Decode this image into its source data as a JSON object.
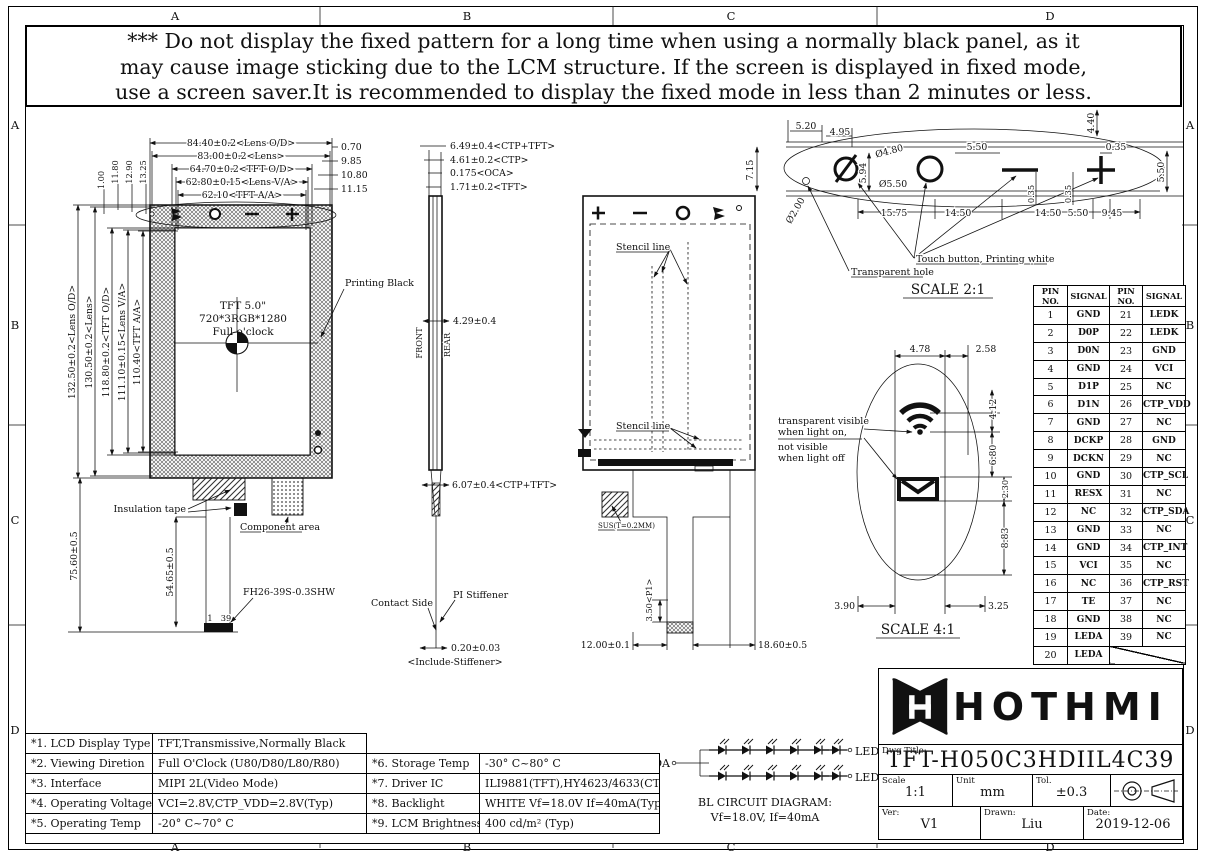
{
  "sheet": {
    "zones_top": [
      "A",
      "B",
      "C",
      "D"
    ],
    "zones_bottom": [
      "A",
      "B",
      "C",
      "D"
    ],
    "zones_left": [
      "A",
      "B",
      "C",
      "D"
    ],
    "zones_right": [
      "A",
      "B",
      "C",
      "D"
    ]
  },
  "warning": {
    "line1": "*** Do not display the fixed pattern for a long time when using a normally black panel, as it",
    "line2": "may cause image sticking due to the LCM structure. If the screen is displayed in fixed mode,",
    "line3": "use a screen saver.It is recommended to display the fixed mode in less than 2 minutes or less."
  },
  "front_view": {
    "dims_top": [
      "84.40±0.2<Lens O/D>",
      "83.00±0.2<Lens>",
      "64.70±0.2<TFT O/D>",
      "62.80±0.15<Lens V/A>",
      "62.10<TFT A/A>"
    ],
    "dims_top_right": [
      "0.70",
      "9.85",
      "10.80",
      "11.15"
    ],
    "dims_left": [
      "132.50±0.2<Lens O/D>",
      "130.50±0.2<Lens>",
      "118.80±0.2<TFT O/D>",
      "111.10±0.15<Lens V/A>",
      "110.40<TFT A/A>"
    ],
    "dims_left_top": [
      "1.00",
      "11.80",
      "12.90",
      "13.25"
    ],
    "dim_total_height": "75.60±0.5",
    "dim_fpc_height": "54.65±0.5",
    "panel_line1": "TFT 5.0\"",
    "panel_line2": "720*3RGB*1280",
    "panel_line3": "Full o'clock",
    "printing_black": "Printing Black",
    "insulation_tape": "Insulation tape",
    "component_area": "Component area",
    "connector": "FH26-39S-0.3SHW",
    "pin_first": "1",
    "pin_last": "39"
  },
  "side_view": {
    "dims_top": [
      "6.49±0.4<CTP+TFT>",
      "4.61±0.2<CTP>",
      "0.175<OCA>",
      "1.71±0.2<TFT>"
    ],
    "dim_mid": "4.29±0.4",
    "dim_lower": "6.07±0.4<CTP+TFT>",
    "front": "FRONT",
    "rear": "REAR",
    "contact_side": "Contact Side",
    "pi_stiffener": "PI Stiffener",
    "dim_tail": "0.20±0.03",
    "tail_note": "<Include-Stiffener>"
  },
  "rear_view": {
    "stencil_top": "Stencil line",
    "stencil_bottom": "Stencil line",
    "sus": "SUS(T=0.2MM)",
    "dim_pitch": "3.50<P1>",
    "dim_fpc_left": "12.00±0.1",
    "dim_fpc_right": "18.60±0.5"
  },
  "detail21": {
    "scale": "SCALE 2:1",
    "touch_label": "Touch button, Printing white",
    "hole_label": "Transparent hole",
    "dims": [
      "5.20",
      "4.95",
      "7.15",
      "Ø2.00",
      "Ø4.80",
      "Ø5.50",
      "5.94",
      "5.50",
      "0.35",
      "4.40",
      "5.50",
      "0.35",
      "0.35",
      "15.75",
      "14.50",
      "14.50",
      "5.50",
      "9.45"
    ]
  },
  "detail41": {
    "scale": "SCALE 4:1",
    "note1": "transparent visible",
    "note2": "when light on,",
    "note3": "not visible",
    "note4": "when light off",
    "dims": [
      "4.78",
      "2.58",
      "4.12",
      "6.80",
      "2.30",
      "8.83",
      "3.90",
      "3.25"
    ]
  },
  "pin_table": {
    "headers": [
      "PIN NO.",
      "SIGNAL",
      "PIN NO.",
      "SIGNAL"
    ],
    "rows": [
      [
        "1",
        "GND",
        "21",
        "LEDK"
      ],
      [
        "2",
        "D0P",
        "22",
        "LEDK"
      ],
      [
        "3",
        "D0N",
        "23",
        "GND"
      ],
      [
        "4",
        "GND",
        "24",
        "VCI"
      ],
      [
        "5",
        "D1P",
        "25",
        "NC"
      ],
      [
        "6",
        "D1N",
        "26",
        "CTP_VDD"
      ],
      [
        "7",
        "GND",
        "27",
        "NC"
      ],
      [
        "8",
        "DCKP",
        "28",
        "GND"
      ],
      [
        "9",
        "DCKN",
        "29",
        "NC"
      ],
      [
        "10",
        "GND",
        "30",
        "CTP_SCL"
      ],
      [
        "11",
        "RESX",
        "31",
        "NC"
      ],
      [
        "12",
        "NC",
        "32",
        "CTP_SDA"
      ],
      [
        "13",
        "GND",
        "33",
        "NC"
      ],
      [
        "14",
        "GND",
        "34",
        "CTP_INT"
      ],
      [
        "15",
        "VCI",
        "35",
        "NC"
      ],
      [
        "16",
        "NC",
        "36",
        "CTP_RST"
      ],
      [
        "17",
        "TE",
        "37",
        "NC"
      ],
      [
        "18",
        "GND",
        "38",
        "NC"
      ],
      [
        "19",
        "LEDA",
        "39",
        "NC"
      ]
    ],
    "last_row": {
      "pin": "20",
      "signal": "LEDA"
    }
  },
  "spec_left": {
    "rows": [
      [
        "*1. LCD Display Type",
        "TFT,Transmissive,Normally Black"
      ],
      [
        "*2. Viewing Diretion",
        "Full O'Clock (U80/D80/L80/R80)"
      ],
      [
        "*3. Interface",
        "MIPI 2L(Video Mode)"
      ],
      [
        "*4. Operating Voltage",
        "VCI=2.8V,CTP_VDD=2.8V(Typ)"
      ],
      [
        "*5. Operating Temp",
        "-20° C~70° C"
      ]
    ]
  },
  "spec_right": {
    "rows": [
      [
        "*6. Storage Temp",
        "-30° C~80° C"
      ],
      [
        "*7. Driver IC",
        "ILI9881(TFT),HY4623/4633(CTP)"
      ],
      [
        "*8. Backlight",
        "WHITE Vf=18.0V If=40mA(Typ)"
      ],
      [
        "*9. LCM Brightness",
        "400 cd/m² (Typ)"
      ]
    ]
  },
  "bl_circuit": {
    "leda": "LEDA",
    "ledk1": "LEDK1",
    "ledk2": "LEDK2",
    "title": "BL CIRCUIT DIAGRAM:",
    "subtitle": "Vf=18.0V, If=40mA"
  },
  "title_block": {
    "brand": "HOTHMI",
    "dwg_title_label": "Dwg Title:",
    "dwg_title": "TFT-H050C3HDIIL4C39",
    "scale_label": "Scale",
    "scale": "1:1",
    "unit_label": "Unit",
    "unit": "mm",
    "tol_label": "Tol.",
    "tol": "±0.3",
    "ver_label": "Ver:",
    "ver": "V1",
    "drawn_label": "Drawn:",
    "drawn": "Liu",
    "date_label": "Date:",
    "date": "2019-12-06"
  }
}
